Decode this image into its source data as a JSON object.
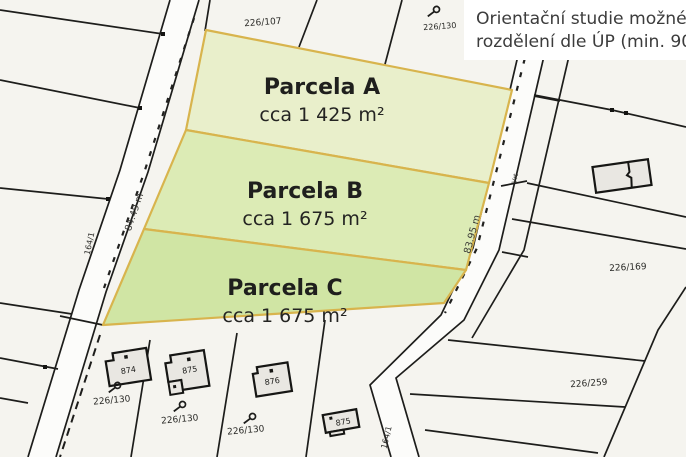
{
  "title": {
    "line1": "Orientační studie možného",
    "line2": "rozdělení dle ÚP (min. 900 m²)"
  },
  "parcels": [
    {
      "name": "Parcela A",
      "area": "cca 1 425 m²"
    },
    {
      "name": "Parcela B",
      "area": "cca 1 675 m²"
    },
    {
      "name": "Parcela C",
      "area": "cca 1 675 m²"
    }
  ],
  "lots": {
    "top": "226/107",
    "top_right": "226/130",
    "right": "226/169",
    "bottom_right": "226/259",
    "bottom_a": "226/130",
    "bottom_b": "226/130",
    "bottom_c": "226/130"
  },
  "roads": {
    "left_length": "84.49 m",
    "right_length": "83.95 m",
    "left_id": "164/1",
    "right_id": "164/1",
    "borehole": "Vrt"
  },
  "buildings": {
    "b1": "874",
    "b2": "875",
    "b3": "876",
    "b4": "875"
  },
  "colors": {
    "background": "#f5f4ef",
    "road_fill": "#fcfcfa",
    "line": "#1d1d1b",
    "parcel_a": "#e9efcb",
    "parcel_b": "#dcebb5",
    "parcel_c": "#d0e5a4",
    "parcel_outline": "#d8b44d",
    "building_fill": "#e9e7e2",
    "title_bg": "#ffffff"
  }
}
